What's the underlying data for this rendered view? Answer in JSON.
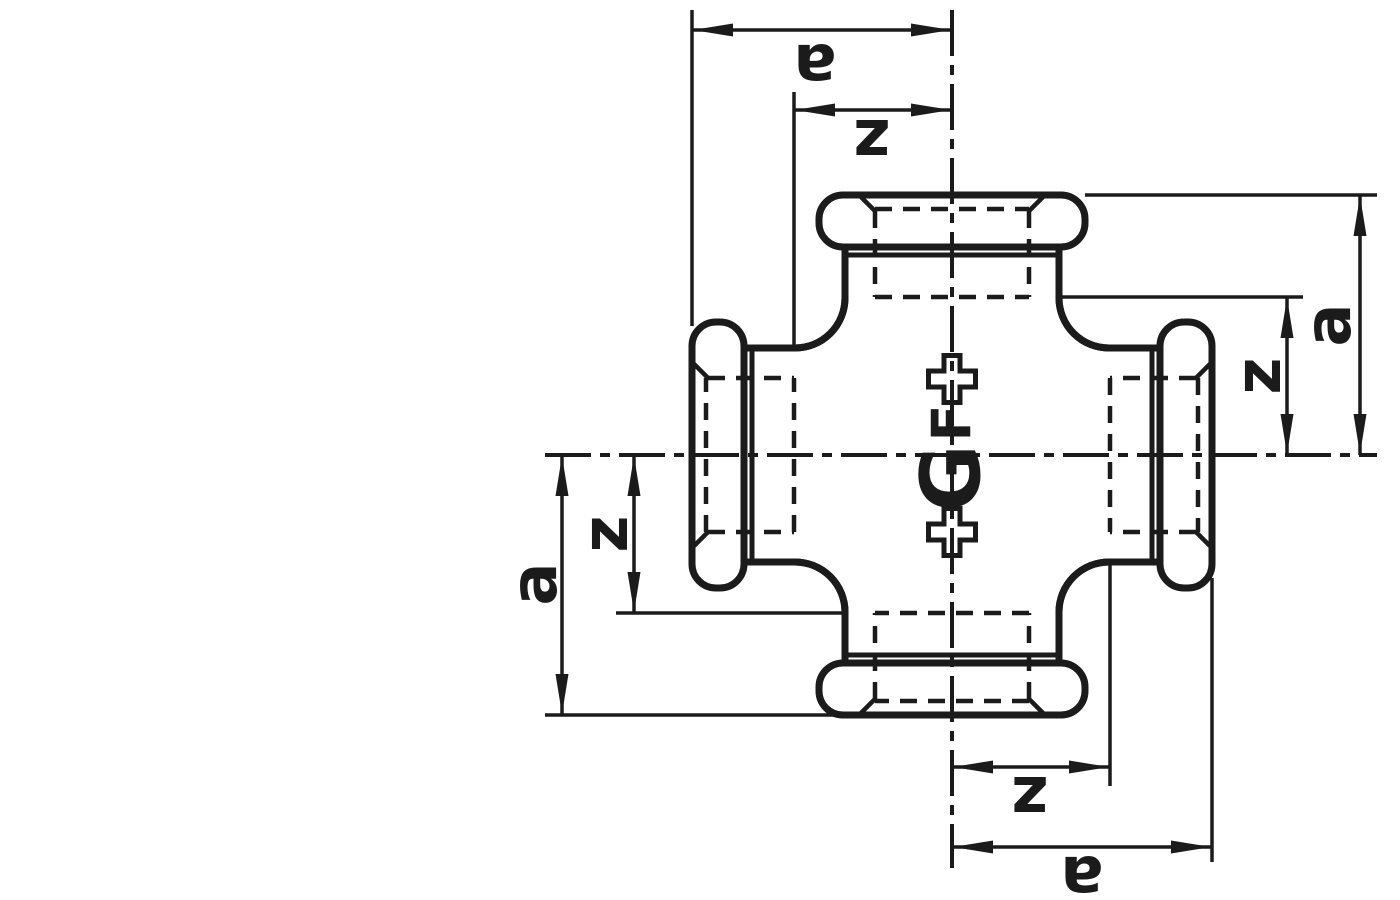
{
  "drawing": {
    "colors": {
      "line": "#1b1b1b",
      "background": "#ffffff"
    },
    "dimensions": {
      "top": {
        "outer": "a",
        "inner": "z"
      },
      "right": {
        "outer": "a",
        "inner": "z"
      },
      "bottom": {
        "outer": "a",
        "inner": "z"
      },
      "left": {
        "outer": "a",
        "inner": "z"
      }
    },
    "logo": {
      "mark": "+GF+",
      "plus_top": "+",
      "letter_f": "F",
      "letter_g": "G",
      "plus_bottom": "+"
    }
  }
}
